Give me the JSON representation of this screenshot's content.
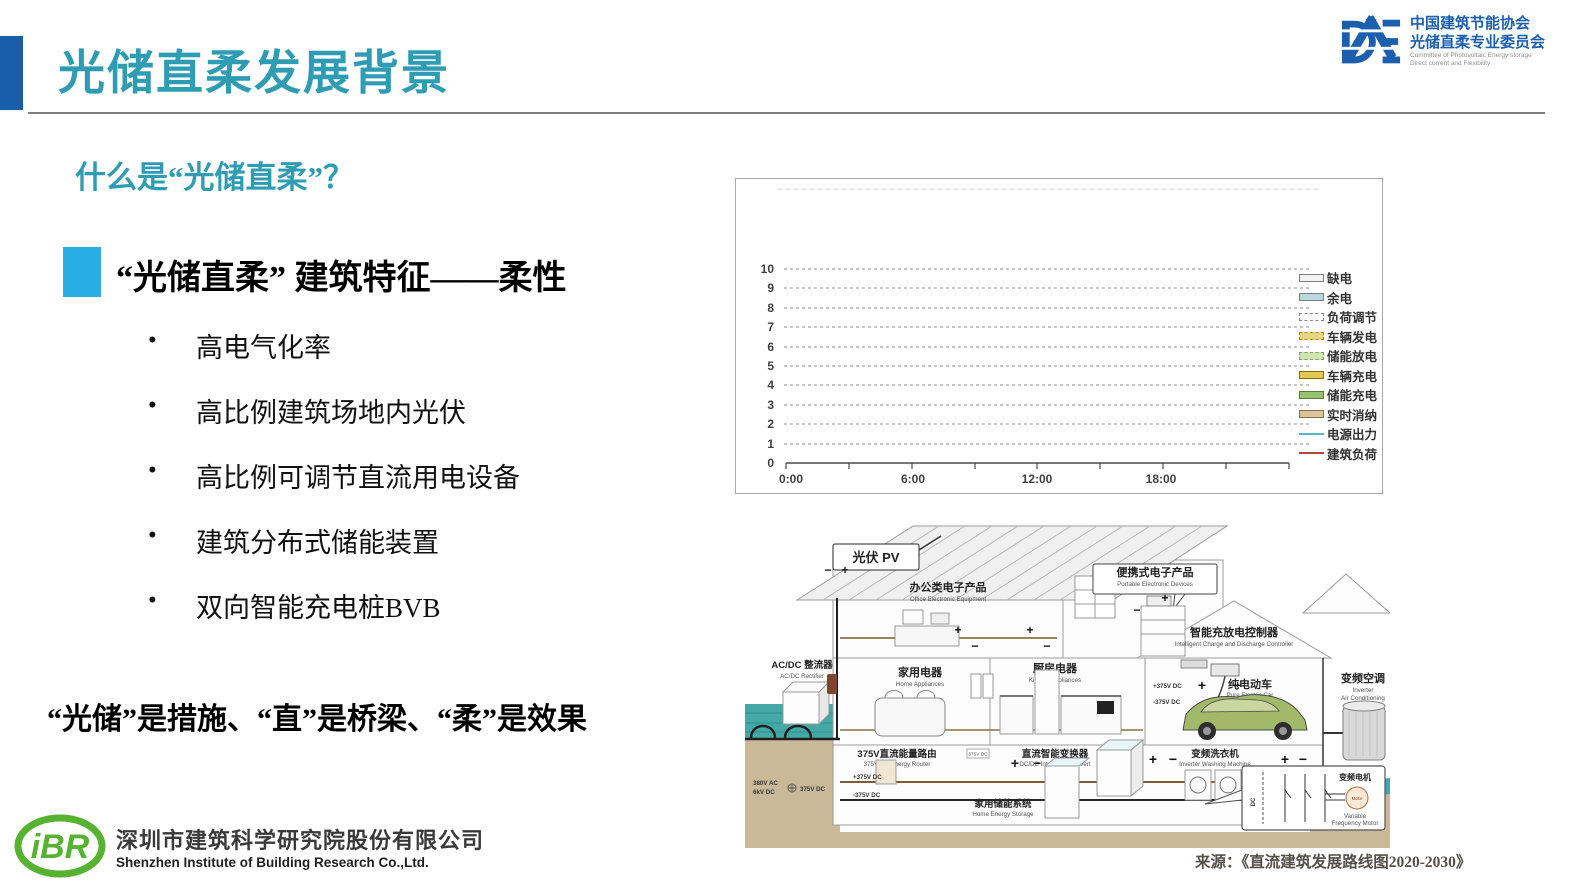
{
  "page": {
    "title": "光储直柔发展背景"
  },
  "header": {
    "logo": {
      "cn1": "中国建筑节能协会",
      "cn2": "光储直柔专业委员会",
      "en1": "Committee of Photovoltaic Energy storage",
      "en2": "Direct current and Flexibility"
    }
  },
  "content": {
    "question": "什么是“光储直柔”？",
    "feature_heading": "“光储直柔” 建筑特征——柔性",
    "bullets": [
      "高电气化率",
      "高比例建筑场地内光伏",
      "高比例可调节直流用电设备",
      "建筑分布式储能装置",
      "双向智能充电桩BVB"
    ],
    "statement": "“光储”是措施、“直”是桥梁、“柔”是效果"
  },
  "footer": {
    "ibr_logo_text": "iBR",
    "company_cn": "深圳市建筑科学研究院股份有限公司",
    "company_en": "Shenzhen Institute of Building Research Co.,Ltd."
  },
  "chart_data": {
    "type": "line",
    "title": "",
    "xlabel": "",
    "ylabel": "",
    "x_ticks": [
      "0:00",
      "6:00",
      "12:00",
      "18:00"
    ],
    "x_range": [
      "0:00",
      "24:00"
    ],
    "y_ticks": [
      "10",
      "9",
      "8",
      "7",
      "6",
      "5",
      "4",
      "3",
      "2",
      "1",
      "0"
    ],
    "ylim": [
      0,
      10
    ],
    "grid": "dashed-horizontal",
    "legend_position": "right",
    "plot_area_empty": true,
    "series": [
      {
        "name": "缺电",
        "swatch": "box",
        "color": "#f3f3f3",
        "border": "solid",
        "values": []
      },
      {
        "name": "余电",
        "swatch": "box",
        "color": "#b9d9df",
        "border": "solid",
        "values": []
      },
      {
        "name": "负荷调节",
        "swatch": "box",
        "color": "#fafafa",
        "border": "dashed",
        "values": []
      },
      {
        "name": "车辆发电",
        "swatch": "box",
        "color": "#ead57f",
        "border": "dashed",
        "values": []
      },
      {
        "name": "储能放电",
        "swatch": "box",
        "color": "#cfe5b0",
        "border": "dashed",
        "values": []
      },
      {
        "name": "车辆充电",
        "swatch": "box",
        "color": "#e4c94f",
        "border": "solid",
        "values": []
      },
      {
        "name": "储能充电",
        "swatch": "box",
        "color": "#97c26f",
        "border": "solid",
        "values": []
      },
      {
        "name": "实时消纳",
        "swatch": "box",
        "color": "#dbc495",
        "border": "solid",
        "values": []
      },
      {
        "name": "电源出力",
        "swatch": "line",
        "color": "#5ab4c4",
        "values": []
      },
      {
        "name": "建筑负荷",
        "swatch": "line",
        "color": "#b0492f",
        "values": []
      }
    ]
  },
  "diagram": {
    "source": "来源：《直流建筑发展路线图2020-2030》",
    "labels": {
      "pv": {
        "cn": "光伏 PV"
      },
      "office": {
        "cn": "办公类电子产品",
        "en": "Office Electronic Equipment"
      },
      "portable": {
        "cn": "便携式电子产品",
        "en": "Portable Electronic Devices"
      },
      "controller": {
        "cn": "智能充放电控制器",
        "en": "Intelligent Charge and Discharge Controller"
      },
      "home_app": {
        "cn": "家用电器",
        "en": "Home Appliances"
      },
      "kitchen": {
        "cn": "厨房电器",
        "en": "Kitchen Appliances"
      },
      "car": {
        "cn": "纯电动车",
        "en": "Pure Electric Car"
      },
      "hvac": {
        "cn": "变频空调",
        "en1": "Inverter",
        "en2": "Air Conditioning"
      },
      "rectifier": {
        "cn": "AC/DC 整流器",
        "en": "AC/DC Rectifier"
      },
      "router": {
        "cn": "375V直流能量路由",
        "en": "375V DC Energy Router"
      },
      "converter": {
        "cn": "直流智能变换器",
        "en": "DC/DC Intelligent Convert"
      },
      "washer": {
        "cn": "变频洗衣机",
        "en": "Inverter Washing Machine"
      },
      "storage": {
        "cn": "家用储能系统",
        "en": "Home Energy Storage"
      },
      "motor": {
        "cn": "变频电机",
        "en1": "Variable",
        "en2": "Frequency Motor",
        "motor_tag": "Motor",
        "dc_tag": "DC"
      },
      "grid_in": {
        "l1": "380V AC",
        "l2": "6kV DC",
        "l3": "375V DC"
      },
      "dc_plus": "+375V DC",
      "dc_minus": "-375V DC",
      "plus": "+",
      "minus": "−",
      "router_tag": "375V DC"
    }
  },
  "colors": {
    "accent_teal": "#2e9cb3",
    "title_bar_blue": "#1a5ea9",
    "bullet_cyan": "#29aee3",
    "logo_blue": "#1c5fad",
    "ibr_green": "#56b230",
    "ground_tan": "#c9b998",
    "water_teal": "#44a8a6"
  }
}
